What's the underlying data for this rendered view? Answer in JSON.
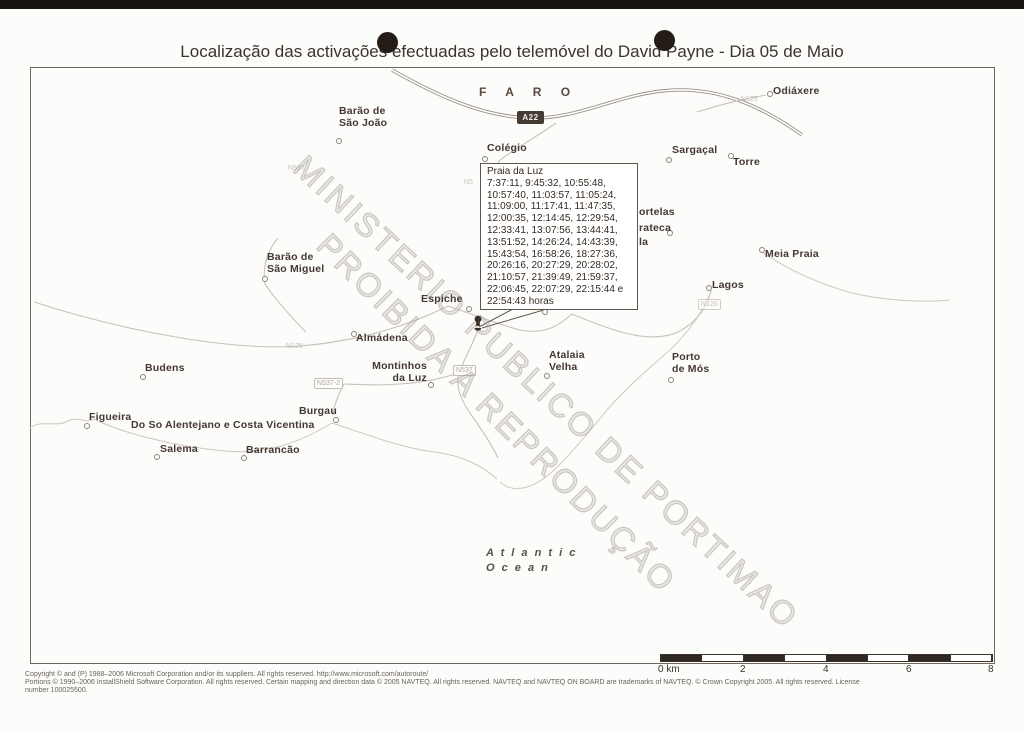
{
  "page": {
    "title": "Localização das activações efectuadas pelo telemóvel do David Payne - Dia 05 de Maio"
  },
  "map": {
    "district_label": "F A R O",
    "highway_shield": "A22",
    "watermark_line1": "MINISTERIO PUBLICO DE PORTIMAO",
    "watermark_line2": "PROIBIDA A REPRODUÇÃO",
    "ocean_label_line1": "A t l a n t i c",
    "ocean_label_line2": "O c e a n"
  },
  "callout": {
    "title": "Praia da Luz",
    "lines": [
      "7:37:11, 9:45:32, 10:55:48,",
      "10:57:40, 11:03:57, 11:05:24,",
      "11:09:00, 11:17:41, 11:47:35,",
      "12:00:35, 12:14:45, 12:29:54,",
      "12:33:41, 13:07:56, 13:44:41,",
      "13:51:52, 14:26:24, 14:43:39,",
      "15:43:54, 16:58:26, 18:27:36,",
      "20:26:16, 20:27:29, 20:28:02,",
      "21:10:57, 21:39:49, 21:59:37,",
      "22:06:45, 22:07:29, 22:15:44 e",
      "22:54:43 horas"
    ]
  },
  "town_labels": [
    {
      "text": "Barão de\nSão João",
      "style": {
        "left": "339px",
        "top": "106px"
      }
    },
    {
      "text": "Odiáxere",
      "style": {
        "left": "773px",
        "top": "86px"
      }
    },
    {
      "text": "Colégio",
      "style": {
        "left": "487px",
        "top": "143px"
      }
    },
    {
      "text": "Sargaçal",
      "style": {
        "left": "672px",
        "top": "145px"
      }
    },
    {
      "text": "Torre",
      "style": {
        "left": "733px",
        "top": "157px"
      }
    },
    {
      "text": "Meia Praia",
      "style": {
        "left": "765px",
        "top": "249px"
      }
    },
    {
      "text": "Lagos",
      "style": {
        "left": "712px",
        "top": "280px"
      }
    },
    {
      "text": "Barão de\nSão Miguel",
      "style": {
        "left": "267px",
        "top": "252px"
      }
    },
    {
      "text": "Espiche",
      "style": {
        "left": "421px",
        "top": "294px"
      }
    },
    {
      "text": "Valverde",
      "style": {
        "left": "546px",
        "top": "296px"
      }
    },
    {
      "text": "Almádena",
      "style": {
        "left": "356px",
        "top": "333px"
      }
    },
    {
      "text": "Atalaia\nVelha",
      "style": {
        "left": "549px",
        "top": "350px"
      }
    },
    {
      "text": "Porto\nde Mós",
      "style": {
        "left": "672px",
        "top": "352px"
      }
    },
    {
      "text": "Montinhos\nda Luz",
      "style": {
        "left": "371px",
        "top": "361px",
        "width": "56px",
        "textAlign": "right"
      }
    },
    {
      "text": "Budens",
      "style": {
        "left": "145px",
        "top": "363px"
      }
    },
    {
      "text": "Figueira",
      "style": {
        "left": "89px",
        "top": "412px"
      }
    },
    {
      "text": "Salema",
      "style": {
        "left": "160px",
        "top": "444px"
      }
    },
    {
      "text": "Barrancão",
      "style": {
        "left": "246px",
        "top": "445px"
      }
    },
    {
      "text": "Burgau",
      "style": {
        "left": "299px",
        "top": "406px"
      }
    },
    {
      "text": "Do So Alentejano e Costa Vicentina",
      "style": {
        "left": "131px",
        "top": "420px"
      }
    },
    {
      "text": "ortelas",
      "style": {
        "left": "639px",
        "top": "207px"
      }
    },
    {
      "text": "rateca",
      "style": {
        "left": "639px",
        "top": "223px"
      }
    },
    {
      "text": "la",
      "style": {
        "left": "639px",
        "top": "237px"
      }
    }
  ],
  "town_markers": [
    {
      "style": {
        "left": "336px",
        "top": "138px"
      }
    },
    {
      "style": {
        "left": "767px",
        "top": "91px"
      }
    },
    {
      "style": {
        "left": "482px",
        "top": "156px"
      }
    },
    {
      "style": {
        "left": "666px",
        "top": "157px"
      }
    },
    {
      "style": {
        "left": "728px",
        "top": "153px"
      }
    },
    {
      "style": {
        "left": "759px",
        "top": "247px"
      }
    },
    {
      "style": {
        "left": "706px",
        "top": "285px"
      }
    },
    {
      "style": {
        "left": "262px",
        "top": "276px"
      }
    },
    {
      "style": {
        "left": "466px",
        "top": "306px"
      }
    },
    {
      "style": {
        "left": "542px",
        "top": "309px"
      }
    },
    {
      "style": {
        "left": "351px",
        "top": "331px"
      }
    },
    {
      "style": {
        "left": "544px",
        "top": "373px"
      }
    },
    {
      "style": {
        "left": "668px",
        "top": "377px"
      }
    },
    {
      "style": {
        "left": "428px",
        "top": "382px"
      }
    },
    {
      "style": {
        "left": "140px",
        "top": "374px"
      }
    },
    {
      "style": {
        "left": "84px",
        "top": "423px"
      }
    },
    {
      "style": {
        "left": "154px",
        "top": "454px"
      }
    },
    {
      "style": {
        "left": "241px",
        "top": "455px"
      }
    },
    {
      "style": {
        "left": "333px",
        "top": "417px"
      }
    },
    {
      "style": {
        "left": "667px",
        "top": "230px"
      }
    }
  ],
  "road_labels": [
    {
      "text": "N125",
      "cls": "faint",
      "style": {
        "left": "741px",
        "top": "95px"
      }
    },
    {
      "text": "N537",
      "cls": "faint",
      "style": {
        "left": "288px",
        "top": "164px"
      }
    },
    {
      "text": "N5",
      "cls": "faint",
      "style": {
        "left": "464px",
        "top": "178px"
      }
    },
    {
      "text": "N125",
      "cls": "faint",
      "style": {
        "left": "286px",
        "top": "342px"
      }
    },
    {
      "text": "N537-2",
      "cls": "boxed",
      "style": {
        "left": "314px",
        "top": "378px"
      }
    },
    {
      "text": "N537",
      "cls": "boxed",
      "style": {
        "left": "453px",
        "top": "365px"
      }
    },
    {
      "text": "N125",
      "cls": "boxed faint",
      "style": {
        "left": "698px",
        "top": "299px"
      }
    }
  ],
  "scale_labels": [
    {
      "text": "0 km",
      "style": {
        "left": "658px"
      }
    },
    {
      "text": "2",
      "style": {
        "left": "740px"
      }
    },
    {
      "text": "4",
      "style": {
        "left": "823px"
      }
    },
    {
      "text": "6",
      "style": {
        "left": "906px"
      }
    },
    {
      "text": "8",
      "style": {
        "left": "988px"
      }
    }
  ],
  "footer": {
    "line1": "Copyright © and (P) 1988–2006 Microsoft Corporation and/or its suppliers. All rights reserved. http://www.microsoft.com/autoroute/",
    "line2": "Portions © 1990–2006 InstallShield Software Corporation. All rights reserved. Certain mapping and direction data © 2005 NAVTEQ. All rights reserved. NAVTEQ and NAVTEQ ON BOARD are trademarks of NAVTEQ. © Crown Copyright 2005. All rights reserved. License",
    "line3": "number 100025500."
  },
  "colors": {
    "label_text": "#443830",
    "road": "#c9c1b9",
    "highway_casing": "#9a9189",
    "shield_bg": "#453b32",
    "scale_dark": "#2f2721",
    "watermark": "#a39791"
  }
}
